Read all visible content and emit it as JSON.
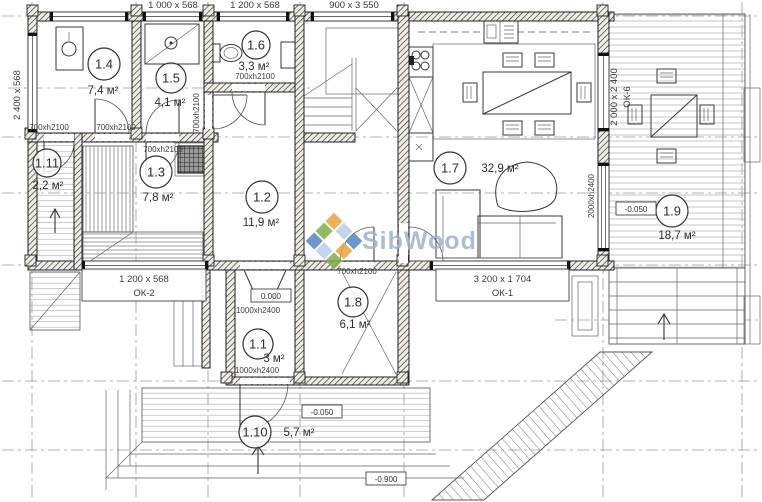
{
  "plan": {
    "watermark": {
      "text": "SibWood",
      "text_color": "#9db3d0",
      "logo_colors": [
        "#e9a33b",
        "#b7cfe8",
        "#4f86c6",
        "#7fb043",
        "#ffffff",
        "#e9a33b",
        "#4f86c6",
        "#b7cfe8",
        "#7fb043"
      ]
    },
    "rooms": [
      {
        "number": "1.1",
        "area": "3 м²",
        "cx": 258,
        "cy": 344,
        "r": 15,
        "ax": 274,
        "ay": 362
      },
      {
        "number": "1.2",
        "area": "11,9 м²",
        "cx": 262,
        "cy": 197,
        "r": 16,
        "ax": 261,
        "ay": 226
      },
      {
        "number": "1.3",
        "area": "7,8 м²",
        "cx": 156,
        "cy": 172,
        "r": 16,
        "ax": 158,
        "ay": 201
      },
      {
        "number": "1.4",
        "area": "7,4 м²",
        "cx": 104,
        "cy": 64,
        "r": 16,
        "ax": 103,
        "ay": 94
      },
      {
        "number": "1.5",
        "area": "4,1 м²",
        "cx": 171,
        "cy": 78,
        "r": 15,
        "ax": 170,
        "ay": 106
      },
      {
        "number": "1.6",
        "area": "3,3 м²",
        "cx": 256,
        "cy": 45,
        "r": 14,
        "ax": 254,
        "ay": 70
      },
      {
        "number": "1.7",
        "area": "32,9 м²",
        "cx": 450,
        "cy": 168,
        "r": 16,
        "ax": 500,
        "ay": 172
      },
      {
        "number": "1.8",
        "area": "6,1 м²",
        "cx": 353,
        "cy": 302,
        "r": 15,
        "ax": 355,
        "ay": 328
      },
      {
        "number": "1.9",
        "area": "18,7 м²",
        "cx": 672,
        "cy": 211,
        "r": 16,
        "ax": 677,
        "ay": 239
      },
      {
        "number": "1.10",
        "area": "5,7 м²",
        "cx": 255,
        "cy": 432,
        "r": 16,
        "ax": 299,
        "ay": 436
      },
      {
        "number": "1.11",
        "area": "2,2 м²",
        "cx": 47,
        "cy": 163,
        "r": 14,
        "ax": 48,
        "ay": 189
      }
    ],
    "dim_labels": [
      {
        "text": "2 400 x 568",
        "x": 20,
        "y": 95,
        "rot": -90
      },
      {
        "text": "1 000 x 568",
        "x": 173,
        "y": 8
      },
      {
        "text": "1 200 x 568",
        "x": 255,
        "y": 8
      },
      {
        "text": "900 x 3 550",
        "x": 354,
        "y": 8
      },
      {
        "text": "700xh2100",
        "x": 116,
        "y": 130
      },
      {
        "text": "700xh2100",
        "x": 163,
        "y": 152
      },
      {
        "text": "700xh2100",
        "x": 199,
        "y": 113,
        "rot": -90
      },
      {
        "text": "700xh2100",
        "x": 255,
        "y": 79
      },
      {
        "text": "700xh2100",
        "x": 49,
        "y": 130
      },
      {
        "text": "700xh2100",
        "x": 357,
        "y": 274
      },
      {
        "text": "1000xh2400",
        "x": 258,
        "y": 313
      },
      {
        "text": "1000xh2400",
        "x": 257,
        "y": 373
      },
      {
        "text": "2 000 x 2 400",
        "x": 617,
        "y": 97,
        "rot": -90
      },
      {
        "text": "ОК-6",
        "x": 630,
        "y": 97,
        "rot": -90
      },
      {
        "text": "2000xh2400",
        "x": 594,
        "y": 196,
        "rot": -90
      }
    ],
    "window_tags": [
      {
        "dims": "1 200 x 568",
        "tag": "ОК-2",
        "x": 82,
        "y": 269,
        "w": 124,
        "h": 32
      },
      {
        "dims": "3 200 x 1 704",
        "tag": "ОК-1",
        "x": 436,
        "y": 269,
        "w": 133,
        "h": 32
      }
    ],
    "elevations": [
      {
        "value": "0.000",
        "x": 271,
        "y": 296
      },
      {
        "value": "-0.050",
        "x": 322,
        "y": 412
      },
      {
        "value": "-0.900",
        "x": 386,
        "y": 479
      },
      {
        "value": "-0.050",
        "x": 636,
        "y": 209
      }
    ]
  }
}
